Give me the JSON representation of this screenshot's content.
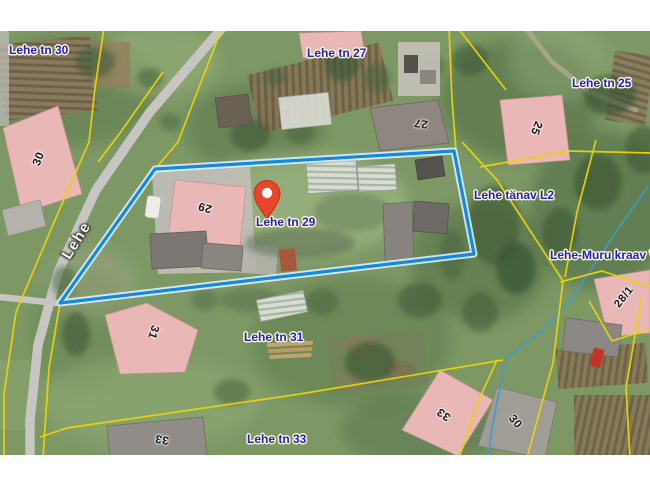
{
  "map": {
    "type": "aerial-cadastral-map",
    "pin": {
      "label": "Lehe tn 29",
      "color": "#ea4528"
    },
    "street_label": {
      "text": "Lehe"
    },
    "labels": [
      {
        "id": "lehe-tn-30",
        "text": "Lehe tn 30"
      },
      {
        "id": "lehe-tn-27",
        "text": "Lehe tn 27"
      },
      {
        "id": "lehe-tn-25",
        "text": "Lehe tn 25"
      },
      {
        "id": "lehe-tanav-l2",
        "text": "Lehe tänav L2"
      },
      {
        "id": "lehe-muru-kraav-v2",
        "text": "Lehe-Muru kraav V2"
      },
      {
        "id": "lehe-tn-29",
        "text": "Lehe tn 29"
      },
      {
        "id": "lehe-tn-31",
        "text": "Lehe tn 31"
      },
      {
        "id": "lehe-tn-33",
        "text": "Lehe tn 33"
      }
    ],
    "house_numbers": [
      {
        "id": "hn-30-nw",
        "text": "30"
      },
      {
        "id": "hn-27",
        "text": "27"
      },
      {
        "id": "hn-25",
        "text": "25"
      },
      {
        "id": "hn-29",
        "text": "29"
      },
      {
        "id": "hn-31",
        "text": "31"
      },
      {
        "id": "hn-33-sw",
        "text": "33"
      },
      {
        "id": "hn-33-se",
        "text": "33"
      },
      {
        "id": "hn-30-se",
        "text": "30"
      },
      {
        "id": "hn-28-1",
        "text": "28/1"
      }
    ],
    "colors": {
      "label_blue": "#2121cd",
      "street_label_white": "#f6f6f6",
      "cadastral_yellow": "#e9d50a",
      "parcel_blue": "#1589e0",
      "parcel_casing": "#ddeffc",
      "ditch_blue": "#3f9ad2",
      "pin_red": "#ea4528",
      "pin_dark": "#c22f12",
      "roof_pink": "#e9b7b5",
      "roof_gray": "#908d88",
      "road_gray": "#c7c6c2",
      "grass": "#7d9865"
    }
  }
}
